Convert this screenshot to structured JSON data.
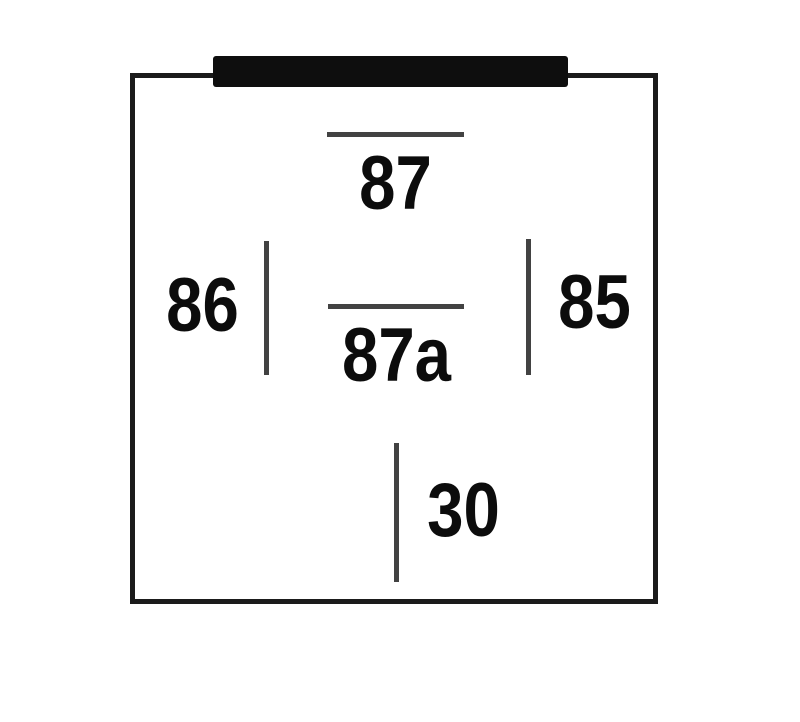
{
  "diagram": {
    "type": "relay-pinout",
    "pins": [
      {
        "label": "87"
      },
      {
        "label": "87a"
      },
      {
        "label": "86"
      },
      {
        "label": "85"
      },
      {
        "label": "30"
      }
    ],
    "colors": {
      "background": "#ffffff",
      "outline": "#1b1b1b",
      "tab": "#0e0e0e",
      "pin_line": "#424242",
      "label_text": "#0c0c0c"
    }
  }
}
